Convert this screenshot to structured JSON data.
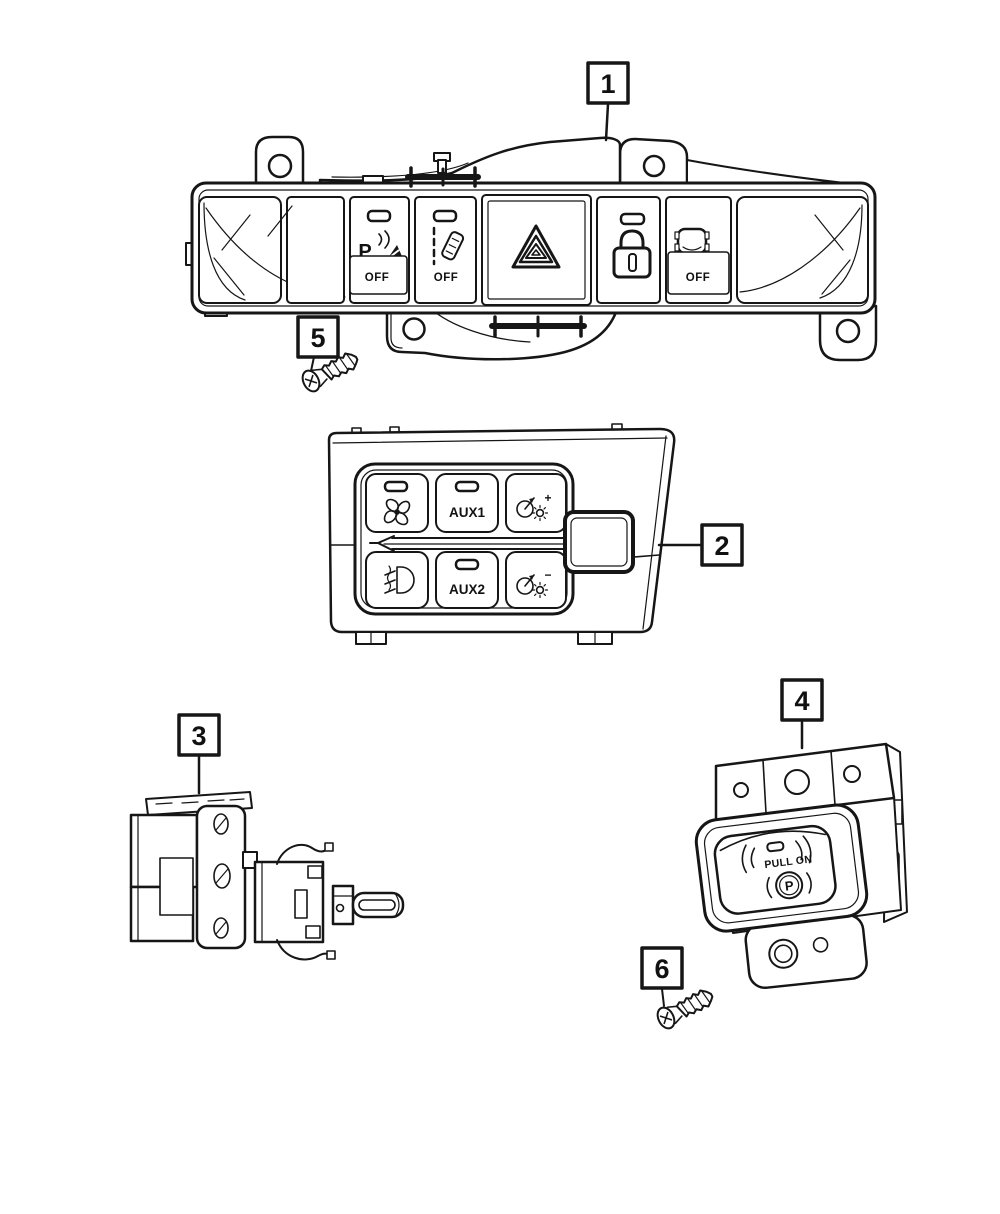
{
  "diagram": {
    "type": "parts-diagram",
    "background": "#ffffff",
    "line_color": "#161616"
  },
  "callouts": {
    "c1": "1",
    "c2": "2",
    "c3": "3",
    "c4": "4",
    "c5": "5",
    "c6": "6"
  },
  "parts": {
    "switch_bank": {
      "callout": "1",
      "buttons": [
        {
          "name": "park-assist-off",
          "symbol": "P",
          "label": "OFF"
        },
        {
          "name": "lane-departure-off",
          "label": "OFF"
        },
        {
          "name": "hazard-flasher",
          "label": ""
        },
        {
          "name": "door-lock",
          "label": ""
        },
        {
          "name": "stability-control-off",
          "label": "OFF"
        }
      ]
    },
    "switch_pod": {
      "callout": "2",
      "buttons": [
        {
          "name": "fan",
          "label": ""
        },
        {
          "name": "aux1",
          "label": "AUX1"
        },
        {
          "name": "dimmer-up",
          "label": "+"
        },
        {
          "name": "fog-lamp",
          "label": ""
        },
        {
          "name": "aux2",
          "label": "AUX2"
        },
        {
          "name": "dimmer-down",
          "label": "−"
        }
      ]
    },
    "headlamp_switch": {
      "callout": "3"
    },
    "park_brake_switch": {
      "callout": "4",
      "label": "PULL ON",
      "symbol": "P"
    },
    "screw_upper": {
      "callout": "5"
    },
    "screw_lower": {
      "callout": "6"
    }
  }
}
